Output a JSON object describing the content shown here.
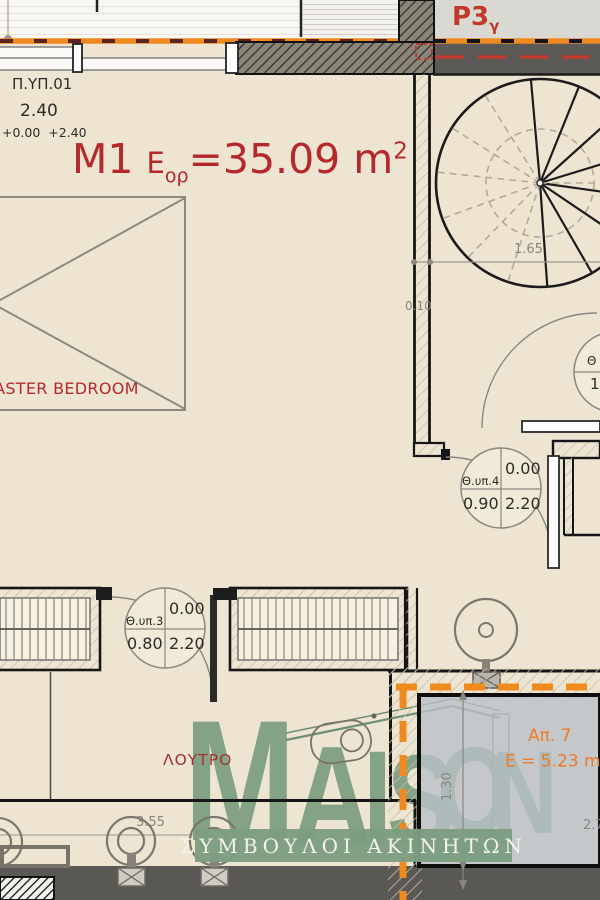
{
  "header": {
    "p3": "P3",
    "p3_sub": "γ"
  },
  "left_info": {
    "unit": "Π.ΥΠ.01",
    "height": "2.40",
    "levels": "+0.00  +2.40"
  },
  "title": {
    "m": "M1",
    "e": "E",
    "e_sub": "ορ",
    "eq": "=35.09 m",
    "sup": "2"
  },
  "rooms": {
    "master": "MASTER BEDROOM",
    "bath": "ΛΟΥΤΡΟ",
    "ap7": "Απ. 7",
    "ap7_area": "E = 5.23 m",
    "ap7_sup": "2"
  },
  "doors": {
    "d4": {
      "label": "Θ.υπ.4",
      "top_right": "0.00",
      "bottom_left": "0.90",
      "bottom_right": "2.20"
    },
    "d3": {
      "label": "Θ.υπ.3",
      "top_right": "0.00",
      "bottom_left": "0.80",
      "bottom_right": "2.20"
    },
    "d5_partial": {
      "label": "Θ",
      "value": "1"
    }
  },
  "dims": {
    "stair": "1.65",
    "wall": "0.10",
    "bath": "3.55",
    "ap7_height": "1.30",
    "ap7_width": "2.7"
  },
  "logo": {
    "letters": [
      "M",
      "A",
      "I",
      "S",
      "O",
      "N"
    ],
    "tagline": "ΣΥΜΒΟΥΛΟΙ ΑΚΙΝΗΤΩΝ"
  },
  "colors": {
    "accent_orange": "#F08A1D",
    "plan_red": "#B5282C",
    "logo_green": "#7D9D81",
    "dark_band": "#5B5A56",
    "background": "#EDE5D2"
  }
}
